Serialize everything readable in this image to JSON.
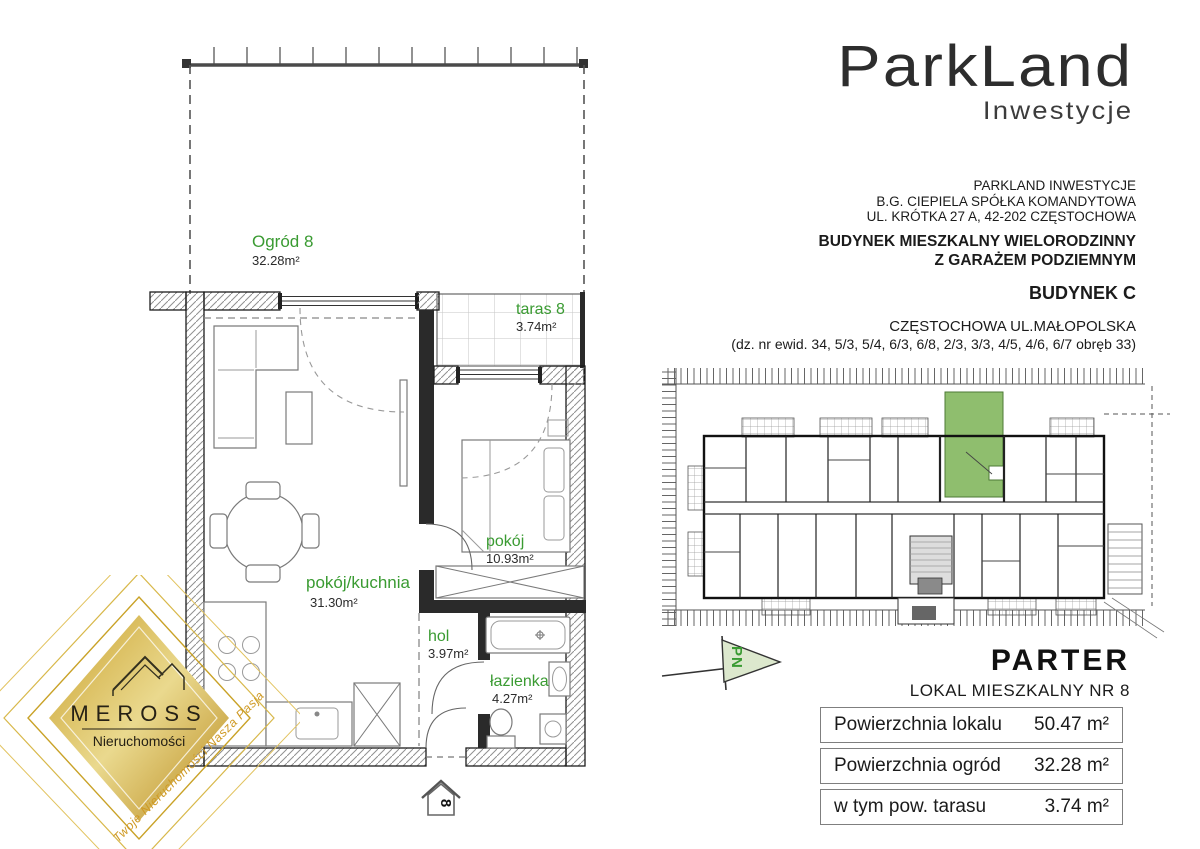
{
  "brand": {
    "logo_text": "ParkLand",
    "logo_subtext": "Inwestycje"
  },
  "developer": {
    "line1": "PARKLAND INWESTYCJE",
    "line2": "B.G. CIEPIELA SPÓŁKA KOMANDYTOWA",
    "line3": "UL. KRÓTKA 27 A, 42-202 CZĘSTOCHOWA",
    "building_line1": "BUDYNEK MIESZKALNY WIELORODZINNY",
    "building_line2": "Z GARAŻEM PODZIEMNYM",
    "building_name": "BUDYNEK C",
    "location": "CZĘSTOCHOWA UL.MAŁOPOLSKA",
    "plots": "(dz. nr ewid. 34, 5/3, 5/4, 6/3, 6/8, 2/3, 3/3, 4/5, 4/6, 6/7 obręb 33)"
  },
  "floor": {
    "title": "PARTER",
    "unit": "LOKAL MIESZKALNY NR 8"
  },
  "areas_table": {
    "rows": [
      {
        "label": "Powierzchnia lokalu",
        "value": "50.47 m²"
      },
      {
        "label": "Powierzchnia ogród",
        "value": "32.28 m²"
      },
      {
        "label": "w tym pow. tarasu",
        "value": "3.74 m²"
      }
    ]
  },
  "plan": {
    "rooms": [
      {
        "name": "Ogród 8",
        "area": "32.28m²"
      },
      {
        "name": "taras 8",
        "area": "3.74m²"
      },
      {
        "name": "pokój/kuchnia",
        "area": "31.30m²"
      },
      {
        "name": "pokój",
        "area": "10.93m²"
      },
      {
        "name": "hol",
        "area": "3.97m²"
      },
      {
        "name": "łazienka",
        "area": "4.27m²"
      }
    ],
    "entrance_number": "8",
    "compass_label": "PN"
  },
  "watermark": {
    "name": "MEROSS",
    "subtitle": "Nieruchomości",
    "tagline": "Twoje Nieruchomości Nasza Pasja"
  },
  "colors": {
    "room_label_green": "#3a9b32",
    "highlight_unit_green": "#8fbe6e",
    "compass_fill": "#dce8cd",
    "gold": "#c9a227",
    "text_dark": "#1b1b1b"
  }
}
